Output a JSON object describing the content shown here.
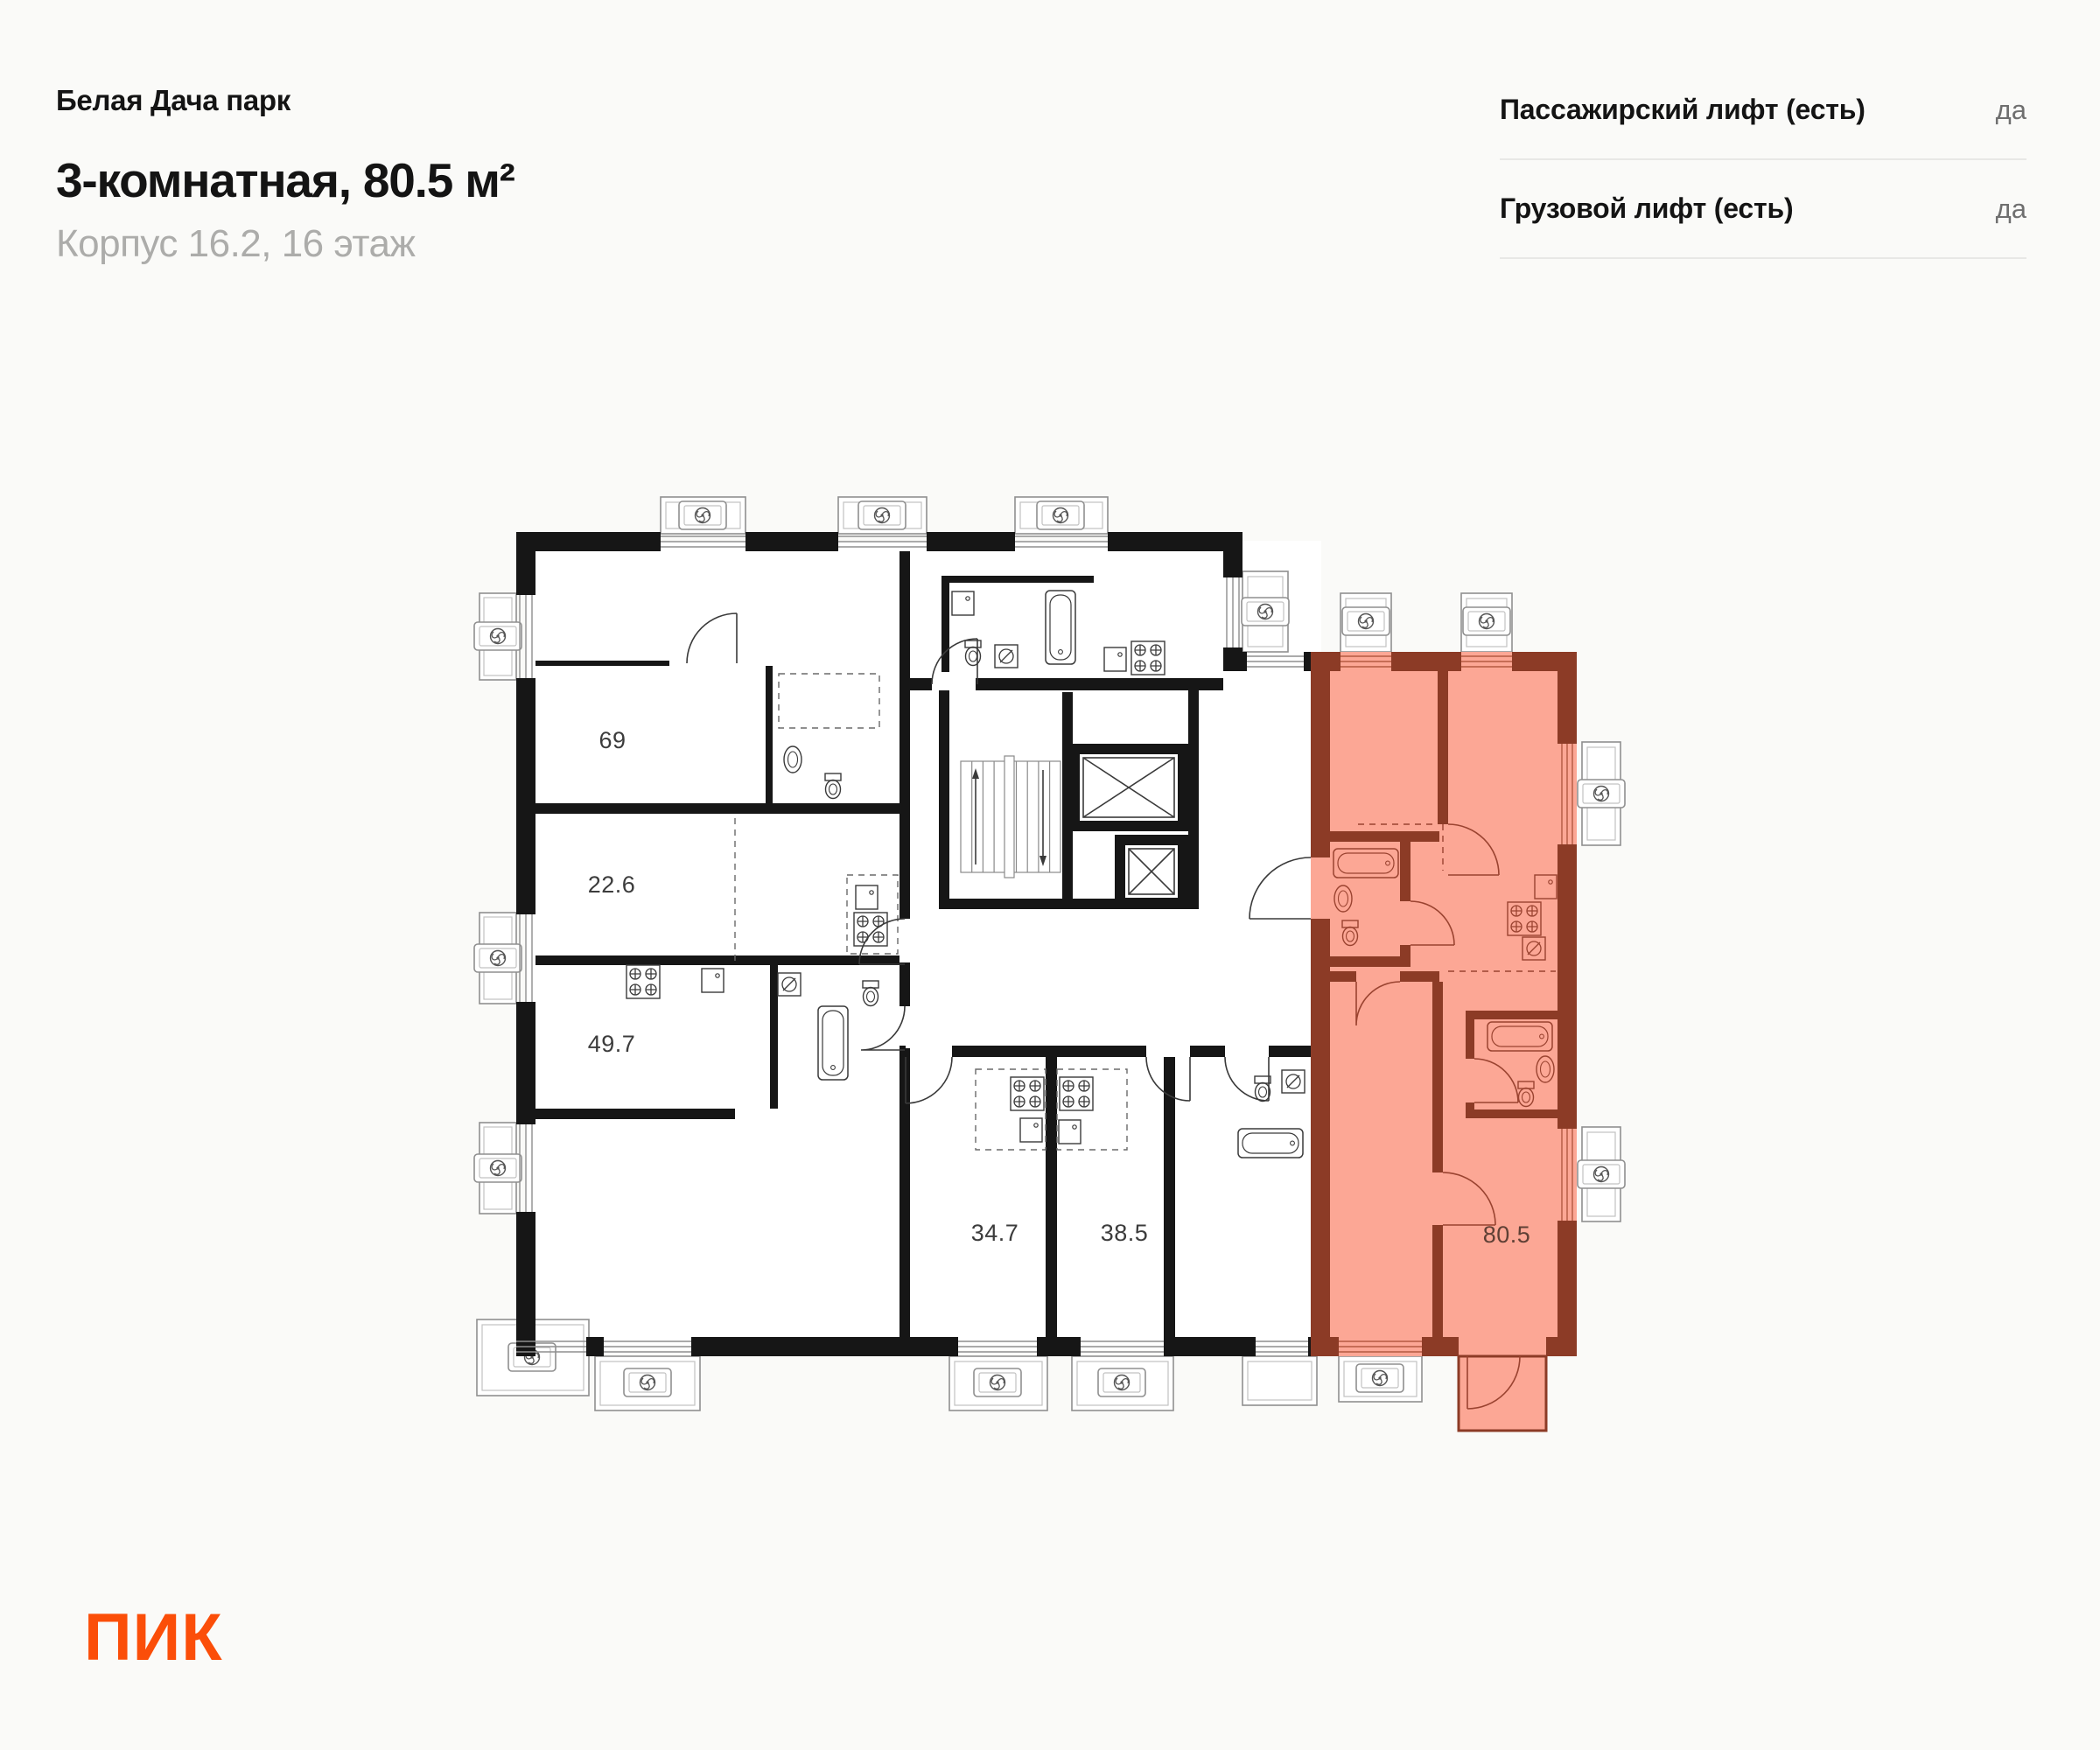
{
  "header": {
    "project": "Белая Дача парк",
    "title": "3-комнатная, 80.5 м²",
    "subtitle": "Корпус 16.2, 16 этаж"
  },
  "info_rows": [
    {
      "label": "Пассажирский лифт (есть)",
      "value": "да"
    },
    {
      "label": "Грузовой лифт (есть)",
      "value": "да"
    }
  ],
  "logo": {
    "text": "ПИК",
    "color": "#FB4E09"
  },
  "plan": {
    "units": [
      {
        "area": "69",
        "highlighted": false
      },
      {
        "area": "22.6",
        "highlighted": false
      },
      {
        "area": "49.7",
        "highlighted": false
      },
      {
        "area": "34.7",
        "highlighted": false
      },
      {
        "area": "38.5",
        "highlighted": false
      },
      {
        "area": "80.5",
        "highlighted": true
      }
    ],
    "colors": {
      "highlight_fill": "#FCA795",
      "highlight_wall": "#8C3B26",
      "wall": "#161616"
    }
  }
}
